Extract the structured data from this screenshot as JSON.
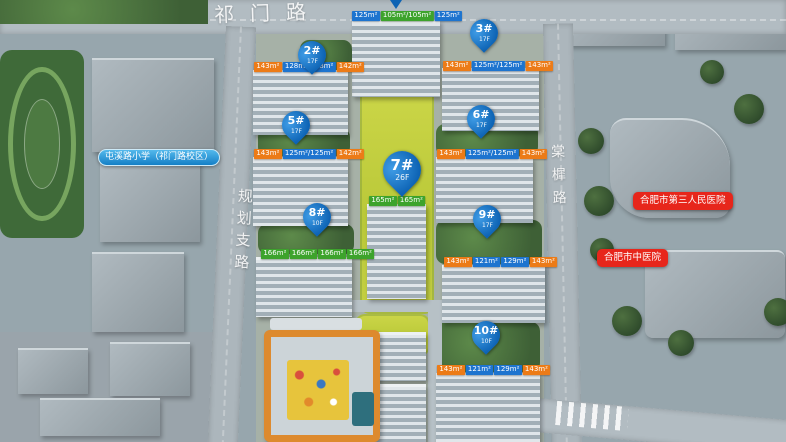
{
  "roads": {
    "top_label": "祁门路",
    "left_label": "规划支路",
    "right_label": "棠樨路"
  },
  "poi_labels": {
    "school": "屯溪路小学（祁门路校区）",
    "hospital_top": "合肥市第三人民医院",
    "hospital_bottom": "合肥市中医院"
  },
  "colors": {
    "pin_blue": "#0d63b4",
    "pin_highlight": "#3f9ce6",
    "tag_orange": "#ec7b17",
    "tag_blue": "#1d74cf",
    "tag_green": "#3da32c",
    "bubble_red": "#e7261b",
    "school_blue": "#147fc6",
    "kindergarten_orange": "#dd8a2e"
  },
  "pins": [
    {
      "label": "2#",
      "floors": "17F",
      "x": 312,
      "y": 36,
      "size": "s"
    },
    {
      "label": "3#",
      "floors": "17F",
      "x": 484,
      "y": 14,
      "size": "s"
    },
    {
      "label": "5#",
      "floors": "17F",
      "x": 296,
      "y": 106,
      "size": "s"
    },
    {
      "label": "6#",
      "floors": "17F",
      "x": 481,
      "y": 100,
      "size": "s"
    },
    {
      "label": "7#",
      "floors": "26F",
      "x": 402,
      "y": 146,
      "size": "l"
    },
    {
      "label": "8#",
      "floors": "10F",
      "x": 317,
      "y": 198,
      "size": "s"
    },
    {
      "label": "9#",
      "floors": "17F",
      "x": 487,
      "y": 200,
      "size": "s"
    },
    {
      "label": "10#",
      "floors": "10F",
      "x": 486,
      "y": 316,
      "size": "s"
    }
  ],
  "area_rows": [
    {
      "building": "1#",
      "x": 352,
      "y": 11,
      "tags": [
        {
          "text": "125m²",
          "color": "blue"
        },
        {
          "text": "105m²/105m²",
          "color": "green"
        },
        {
          "text": "125m²",
          "color": "blue"
        }
      ]
    },
    {
      "building": "2#",
      "x": 254,
      "y": 62,
      "tags": [
        {
          "text": "143m²",
          "color": "orange"
        },
        {
          "text": "128m²/128m²",
          "color": "blue"
        },
        {
          "text": "142m²",
          "color": "orange"
        }
      ]
    },
    {
      "building": "3#",
      "x": 443,
      "y": 61,
      "tags": [
        {
          "text": "143m²",
          "color": "orange"
        },
        {
          "text": "125m²/125m²",
          "color": "blue"
        },
        {
          "text": "143m²",
          "color": "orange"
        }
      ]
    },
    {
      "building": "5#",
      "x": 254,
      "y": 149,
      "tags": [
        {
          "text": "143m²",
          "color": "orange"
        },
        {
          "text": "125m²/125m²",
          "color": "blue"
        },
        {
          "text": "142m²",
          "color": "orange"
        }
      ]
    },
    {
      "building": "6#",
      "x": 437,
      "y": 149,
      "tags": [
        {
          "text": "143m²",
          "color": "orange"
        },
        {
          "text": "125m²/125m²",
          "color": "blue"
        },
        {
          "text": "143m²",
          "color": "orange"
        }
      ]
    },
    {
      "building": "7#",
      "x": 369,
      "y": 196,
      "tags": [
        {
          "text": "165m²",
          "color": "green"
        },
        {
          "text": "165m²",
          "color": "green"
        }
      ]
    },
    {
      "building": "8#",
      "x": 261,
      "y": 249,
      "tags": [
        {
          "text": "166m²",
          "color": "green"
        },
        {
          "text": "166m²",
          "color": "green"
        },
        {
          "text": "166m²",
          "color": "green"
        },
        {
          "text": "166m²",
          "color": "green"
        }
      ]
    },
    {
      "building": "9#",
      "x": 444,
      "y": 257,
      "tags": [
        {
          "text": "143m²",
          "color": "orange"
        },
        {
          "text": "121m²",
          "color": "blue"
        },
        {
          "text": "129m²",
          "color": "blue"
        },
        {
          "text": "143m²",
          "color": "orange"
        }
      ]
    },
    {
      "building": "10#",
      "x": 437,
      "y": 365,
      "tags": [
        {
          "text": "143m²",
          "color": "orange"
        },
        {
          "text": "121m²",
          "color": "blue"
        },
        {
          "text": "129m²",
          "color": "blue"
        },
        {
          "text": "143m²",
          "color": "orange"
        }
      ]
    }
  ]
}
